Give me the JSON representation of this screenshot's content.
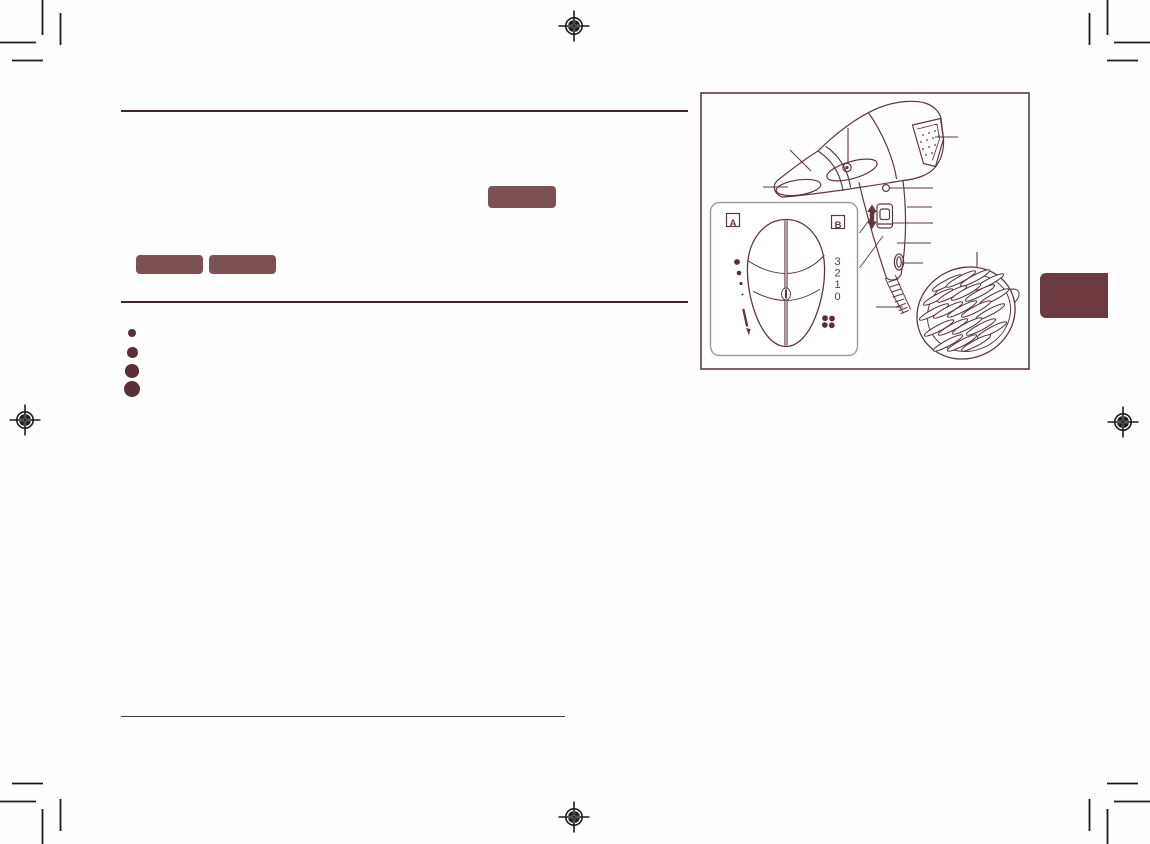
{
  "page": {
    "background_color": "#fefefe",
    "ink_color": "#5e383f",
    "heading_rule_color": "#3d262b",
    "footnote_rule_color": "#3e3e3e",
    "badge_color": "#7d5053",
    "side_tab_color": "#6d3940",
    "bullet_dot_color": "#5c2f37",
    "print_mark_color": "#1b1b1b",
    "inset_border_color": "#a79a9d"
  },
  "content": {
    "redacted_inline_badge": "",
    "redacted_step_badges": [
      "",
      ""
    ],
    "bullet_count": 4
  },
  "diagram": {
    "inset": {
      "view_label_a": "A",
      "view_label_b": "B",
      "switch_positions": [
        "3",
        "2",
        "1",
        "0"
      ],
      "heat_dot_count": 4,
      "icons": [
        "slide-down-arrow-icon",
        "fan-icon"
      ]
    },
    "callouts": {
      "pointer_line_count": 11,
      "slide_arrow_icon": "up-down-arrow-icon"
    }
  },
  "print_marks": {
    "registration_target_count": 4,
    "corner_crop_mark_count": 4
  }
}
